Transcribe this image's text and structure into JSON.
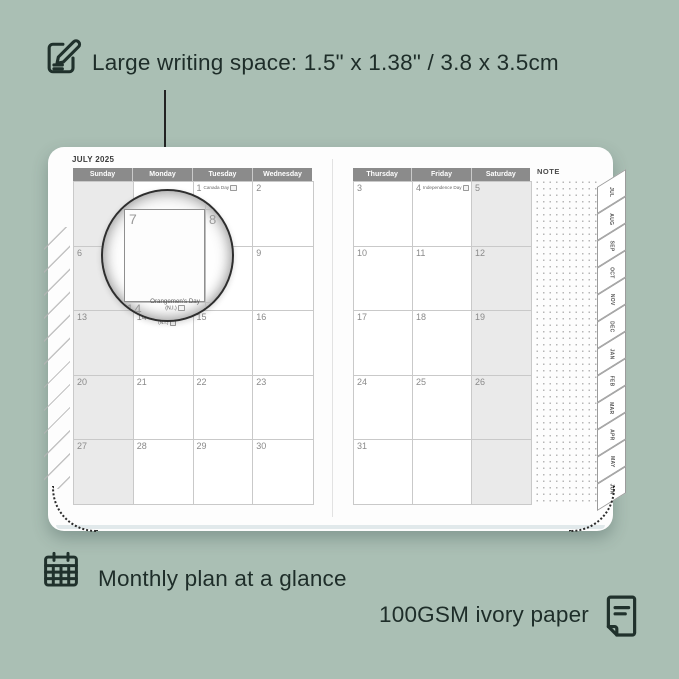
{
  "colors": {
    "background": "#aabfb4",
    "ink": "#1e2d29",
    "header_bar": "#8b8b8b",
    "weekend_fill": "#eaeaea",
    "grid_line": "#c9c9c9",
    "date_text": "#8a8a8a"
  },
  "annotations": {
    "top": {
      "icon": "note-pencil-icon",
      "text": "Large writing space: 1.5\" x 1.38\" / 3.8 x 3.5cm"
    },
    "bottom_left": {
      "icon": "calendar-grid-icon",
      "text": "Monthly plan at a glance"
    },
    "bottom_right": {
      "icon": "paper-icon",
      "text": "100GSM ivory paper"
    }
  },
  "planner": {
    "title": "JULY 2025",
    "note_label": "NOTE",
    "left_page": {
      "headers": [
        "Sunday",
        "Monday",
        "Tuesday",
        "Wednesday"
      ],
      "weekend_col": 0,
      "rows": [
        [
          {
            "d": ""
          },
          {
            "d": ""
          },
          {
            "d": "1",
            "h": "Canada Day",
            "cb": true
          },
          {
            "d": "2"
          }
        ],
        [
          {
            "d": "6"
          },
          {
            "d": "7"
          },
          {
            "d": "8"
          },
          {
            "d": "9"
          }
        ],
        [
          {
            "d": "13"
          },
          {
            "d": "14",
            "h": "Orangemen's Day",
            "h2": "(N.I.)",
            "cb": true
          },
          {
            "d": "15"
          },
          {
            "d": "16"
          }
        ],
        [
          {
            "d": "20"
          },
          {
            "d": "21"
          },
          {
            "d": "22"
          },
          {
            "d": "23"
          }
        ],
        [
          {
            "d": "27"
          },
          {
            "d": "28"
          },
          {
            "d": "29"
          },
          {
            "d": "30"
          }
        ]
      ]
    },
    "right_page": {
      "headers": [
        "Thursday",
        "Friday",
        "Saturday"
      ],
      "weekend_col": 2,
      "rows": [
        [
          {
            "d": "3"
          },
          {
            "d": "4",
            "h": "Independence Day",
            "cb": true
          },
          {
            "d": "5"
          }
        ],
        [
          {
            "d": "10"
          },
          {
            "d": "11"
          },
          {
            "d": "12"
          }
        ],
        [
          {
            "d": "17"
          },
          {
            "d": "18"
          },
          {
            "d": "19"
          }
        ],
        [
          {
            "d": "24"
          },
          {
            "d": "25"
          },
          {
            "d": "26"
          }
        ],
        [
          {
            "d": "31"
          },
          {
            "d": ""
          },
          {
            "d": ""
          }
        ]
      ]
    },
    "tabs": [
      "JUL",
      "AUG",
      "SEP",
      "OCT",
      "NOV",
      "DEC",
      "JAN",
      "FEB",
      "MAR",
      "APR",
      "MAY",
      "JUN"
    ]
  },
  "magnifier": {
    "day": "7",
    "next_day": "8",
    "below_day": "14",
    "holiday": "Orangemen's Day",
    "holiday_sub": "(N.I.)"
  }
}
